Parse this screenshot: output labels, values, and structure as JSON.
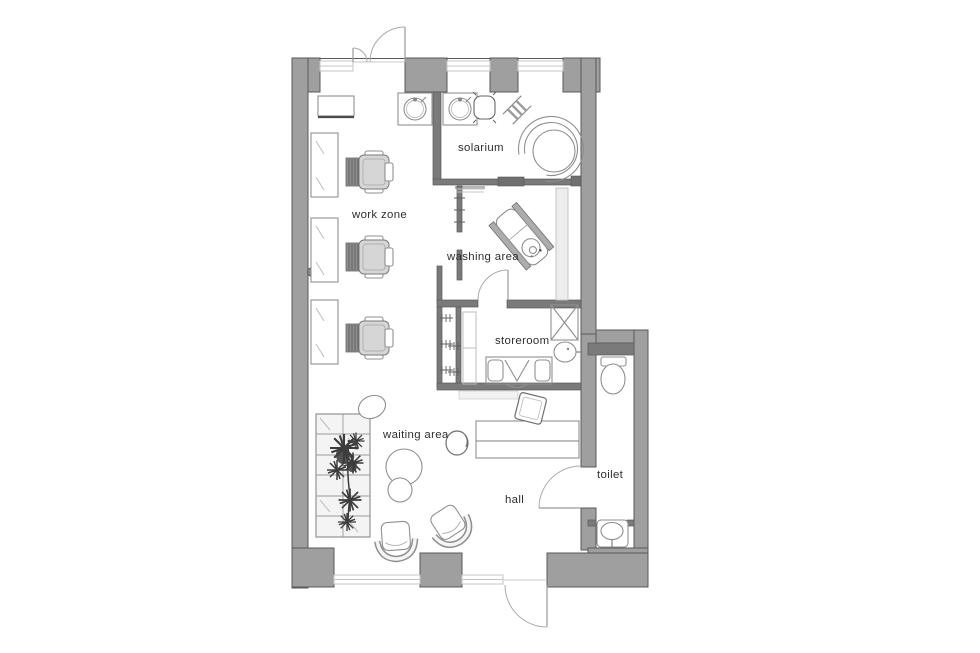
{
  "plan": {
    "type": "floor-plan",
    "subject": "beauty-salon-floor-plan",
    "rooms": [
      {
        "id": "work-zone",
        "label": "work zone"
      },
      {
        "id": "solarium",
        "label": "solarium"
      },
      {
        "id": "washing-area",
        "label": "washing area"
      },
      {
        "id": "storeroom",
        "label": "storeroom"
      },
      {
        "id": "waiting-area",
        "label": "waiting area"
      },
      {
        "id": "hall",
        "label": "hall"
      },
      {
        "id": "toilet",
        "label": "toilet"
      }
    ],
    "furniture": [
      {
        "name": "styling-chair",
        "room": "work-zone",
        "count": 3
      },
      {
        "name": "mirror-station",
        "room": "work-zone",
        "count": 3
      },
      {
        "name": "wall-cabinet",
        "room": "work-zone",
        "count": 1
      },
      {
        "name": "sink-basin",
        "room": "work-zone",
        "count": 1
      },
      {
        "name": "sink-basin",
        "room": "solarium",
        "count": 1
      },
      {
        "name": "stand-up-solarium",
        "room": "solarium",
        "count": 1
      },
      {
        "name": "stool",
        "room": "solarium",
        "count": 1
      },
      {
        "name": "towel-ladder",
        "room": "solarium",
        "count": 1
      },
      {
        "name": "washing-lounger",
        "room": "washing-area",
        "count": 1
      },
      {
        "name": "side-counter",
        "room": "washing-area",
        "count": 1
      },
      {
        "name": "storage-shelves",
        "room": "storeroom",
        "count": 1
      },
      {
        "name": "desk-with-chair",
        "room": "storeroom",
        "count": 1
      },
      {
        "name": "x-cabinet",
        "room": "storeroom",
        "count": 1
      },
      {
        "name": "corner-sink",
        "room": "storeroom",
        "count": 1
      },
      {
        "name": "plant-bench",
        "room": "waiting-area",
        "count": 1
      },
      {
        "name": "ottoman",
        "room": "waiting-area",
        "count": 1
      },
      {
        "name": "armchair",
        "room": "waiting-area",
        "count": 2
      },
      {
        "name": "side-stool",
        "room": "waiting-area",
        "count": 1
      },
      {
        "name": "reception-desk",
        "room": "hall",
        "count": 1
      },
      {
        "name": "reception-chair",
        "room": "hall",
        "count": 1
      },
      {
        "name": "reception-stool",
        "room": "hall",
        "count": 1
      },
      {
        "name": "wc",
        "room": "toilet",
        "count": 1
      },
      {
        "name": "washbasin",
        "room": "toilet",
        "count": 1
      }
    ],
    "doors": [
      {
        "name": "top-entrance-double-door",
        "between": [
          "outside",
          "work-zone"
        ]
      },
      {
        "name": "bottom-entrance-door",
        "between": [
          "outside",
          "hall"
        ]
      },
      {
        "name": "storeroom-door",
        "between": [
          "washing-area",
          "storeroom"
        ]
      },
      {
        "name": "toilet-door",
        "between": [
          "hall",
          "toilet"
        ]
      },
      {
        "name": "solarium-sliding-door",
        "between": [
          "washing-area",
          "solarium"
        ]
      }
    ],
    "windows": {
      "top_wall": 3,
      "bottom_wall": 2
    },
    "colors": {
      "background": "#ffffff",
      "wall": "#9f9f9f",
      "wall_outline": "#5a5a5a",
      "partition": "#7a7a7a",
      "window_line": "#c4c4c4",
      "furniture_outline": "#8f8f8f",
      "furniture_fill": "#ffffff",
      "chair_seat": "#d6d6d6",
      "chair_base": "#8e8e8e",
      "plant": "#3c3c3c",
      "label_text": "#2e2e2e"
    }
  }
}
